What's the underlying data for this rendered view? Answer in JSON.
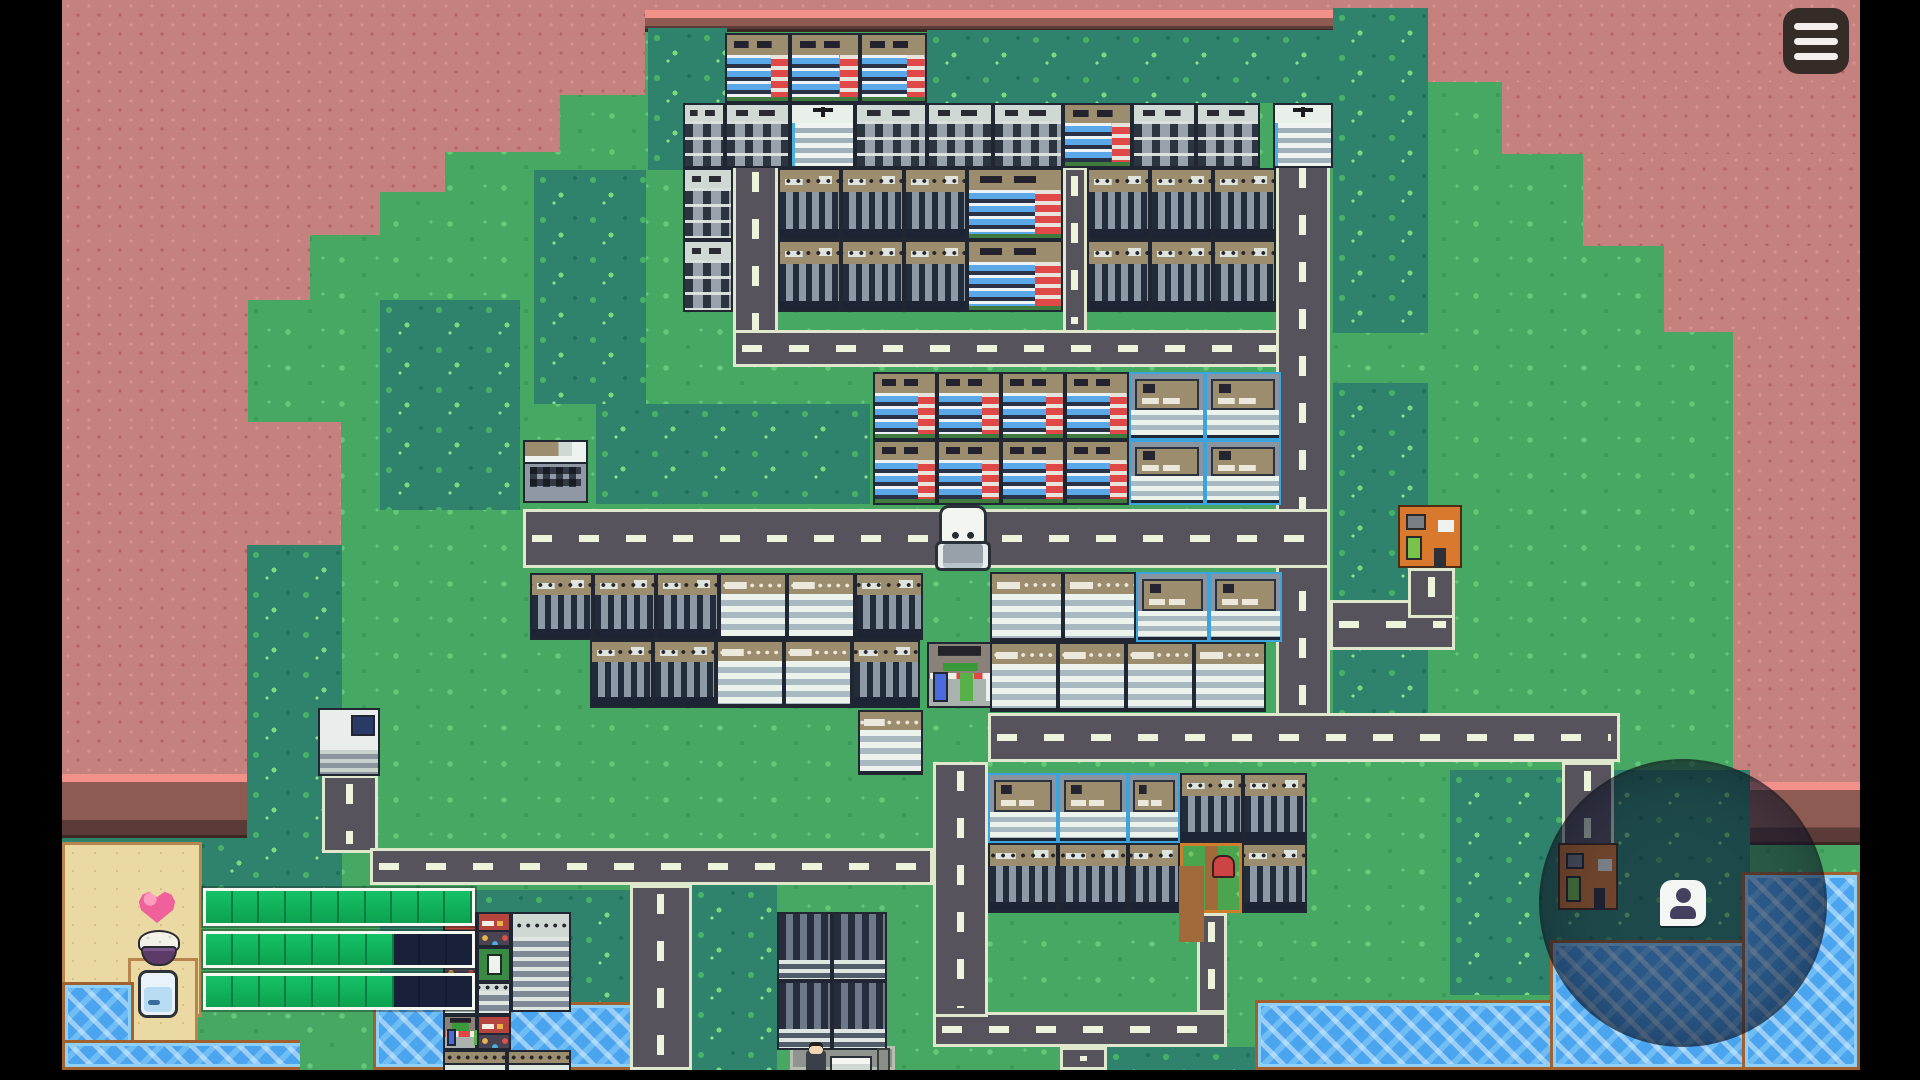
{
  "meta": {
    "app": "pixel-town-survival-game",
    "viewport": {
      "w": 1920,
      "h": 1080
    },
    "content_area": {
      "x": 62,
      "y": 0,
      "w": 1798,
      "h": 1070
    },
    "colors": {
      "grass": "#46a862",
      "tree": "#2f836c",
      "cliff": "#c5817e",
      "water": "#4aa4ee",
      "sand": "#ead9a2",
      "road": "#56535c",
      "road_dash": "#eef4dc",
      "hud_fill": "#10b35c",
      "hud_empty": "#19203a",
      "hud_border": "#f4f8f0",
      "menu_bg": "#352b27",
      "scope_overlay": "rgba(16,22,44,0.52)"
    }
  },
  "menu_button": {
    "icon": "hamburger-menu-icon",
    "bars": 3
  },
  "scope": {
    "x": 1542,
    "y": 762,
    "d": 282,
    "icon": "player-location-pin-icon"
  },
  "hud": {
    "icons_x": 138,
    "bars_x": 203,
    "bars_w": 272,
    "bars": [
      {
        "id": "health",
        "icon": "heart-icon",
        "icon_y": 889,
        "y": 888,
        "h": 38,
        "segments": 10,
        "filled": 10
      },
      {
        "id": "food",
        "icon": "rice-bowl-icon",
        "icon_y": 928,
        "y": 931,
        "h": 37,
        "segments": 10,
        "filled": 7
      },
      {
        "id": "water",
        "icon": "water-glass-icon",
        "icon_y": 970,
        "y": 973,
        "h": 37,
        "segments": 10,
        "filled": 7
      }
    ]
  },
  "map": {
    "terrain": [
      {
        "t": "cliff",
        "n": "cliff-top-strip",
        "x": 62,
        "y": 0,
        "w": 1798,
        "h": 10
      },
      {
        "t": "cliff-foot",
        "n": "cliff-top-strip-foot",
        "x": 62,
        "y": 10,
        "w": 1798,
        "h": 22
      },
      {
        "t": "cliff",
        "n": "cliff-northwest",
        "x": 62,
        "y": 0,
        "w": 583,
        "h": 95
      },
      {
        "t": "cliff",
        "n": "cliff-northwest",
        "x": 62,
        "y": 95,
        "w": 498,
        "h": 57
      },
      {
        "t": "cliff",
        "n": "cliff-northwest",
        "x": 62,
        "y": 152,
        "w": 383,
        "h": 40
      },
      {
        "t": "cliff",
        "n": "cliff-northwest",
        "x": 62,
        "y": 192,
        "w": 318,
        "h": 43
      },
      {
        "t": "cliff",
        "n": "cliff-northwest",
        "x": 62,
        "y": 235,
        "w": 248,
        "h": 65
      },
      {
        "t": "cliff",
        "n": "cliff-west-column",
        "x": 62,
        "y": 300,
        "w": 186,
        "h": 122
      },
      {
        "t": "cliff",
        "n": "cliff-west-bump",
        "x": 62,
        "y": 422,
        "w": 279,
        "h": 152
      },
      {
        "t": "cliff",
        "n": "cliff-west-column",
        "x": 62,
        "y": 574,
        "w": 185,
        "h": 200
      },
      {
        "t": "cliff-foot",
        "n": "cliff-west-bump-foot",
        "x": 247,
        "y": 574,
        "w": 94,
        "h": 62
      },
      {
        "t": "cliff-foot",
        "n": "cliff-west-foot",
        "x": 62,
        "y": 774,
        "w": 185,
        "h": 64
      },
      {
        "t": "cliff",
        "n": "cliff-northeast",
        "x": 1428,
        "y": 0,
        "w": 432,
        "h": 82
      },
      {
        "t": "cliff",
        "n": "cliff-northeast",
        "x": 1502,
        "y": 82,
        "w": 358,
        "h": 72
      },
      {
        "t": "cliff",
        "n": "cliff-northeast",
        "x": 1583,
        "y": 154,
        "w": 277,
        "h": 92
      },
      {
        "t": "cliff",
        "n": "cliff-northeast",
        "x": 1664,
        "y": 246,
        "w": 196,
        "h": 86
      },
      {
        "t": "cliff",
        "n": "cliff-east-column",
        "x": 1733,
        "y": 332,
        "w": 127,
        "h": 450
      },
      {
        "t": "cliff-foot",
        "n": "cliff-east-foot",
        "x": 1733,
        "y": 782,
        "w": 127,
        "h": 63
      },
      {
        "t": "tree",
        "x": 648,
        "y": 28,
        "w": 79,
        "h": 142
      },
      {
        "t": "tree",
        "x": 927,
        "y": 30,
        "w": 406,
        "h": 73
      },
      {
        "t": "tree",
        "x": 1333,
        "y": 8,
        "w": 95,
        "h": 325
      },
      {
        "t": "tree",
        "x": 534,
        "y": 170,
        "w": 112,
        "h": 234
      },
      {
        "t": "tree",
        "x": 380,
        "y": 300,
        "w": 140,
        "h": 210
      },
      {
        "t": "tree",
        "x": 596,
        "y": 404,
        "w": 274,
        "h": 100
      },
      {
        "t": "tree",
        "x": 247,
        "y": 545,
        "w": 95,
        "h": 360
      },
      {
        "t": "tree",
        "x": 62,
        "y": 838,
        "w": 185,
        "h": 62
      },
      {
        "t": "tree",
        "x": 380,
        "y": 890,
        "w": 250,
        "h": 115
      },
      {
        "t": "tree",
        "x": 692,
        "y": 885,
        "w": 85,
        "h": 195
      },
      {
        "t": "tree",
        "x": 1333,
        "y": 383,
        "w": 95,
        "h": 342
      },
      {
        "t": "tree",
        "x": 1450,
        "y": 770,
        "w": 300,
        "h": 225
      },
      {
        "t": "tree",
        "x": 1107,
        "y": 1047,
        "w": 148,
        "h": 23
      },
      {
        "t": "sand",
        "n": "beach",
        "x": 62,
        "y": 842,
        "w": 140,
        "h": 175
      },
      {
        "t": "sand",
        "n": "beach-spit",
        "x": 128,
        "y": 958,
        "w": 70,
        "h": 112
      },
      {
        "t": "water",
        "n": "sea-southwest",
        "x": 62,
        "y": 982,
        "w": 72,
        "h": 88
      },
      {
        "t": "water",
        "n": "sea-southwest",
        "x": 62,
        "y": 1040,
        "w": 246,
        "h": 30
      },
      {
        "t": "grass-patch",
        "x": 300,
        "y": 1022,
        "w": 82,
        "h": 48
      },
      {
        "t": "water",
        "n": "pond",
        "x": 373,
        "y": 1002,
        "w": 285,
        "h": 68
      },
      {
        "t": "water",
        "n": "sea-southeast",
        "x": 1255,
        "y": 1000,
        "w": 605,
        "h": 70
      },
      {
        "t": "water",
        "n": "sea-southeast",
        "x": 1550,
        "y": 940,
        "w": 310,
        "h": 130
      },
      {
        "t": "water",
        "n": "sea-east",
        "x": 1742,
        "y": 872,
        "w": 118,
        "h": 198
      }
    ],
    "roads": [
      {
        "t": "v",
        "n": "road-top-cluster-west",
        "x": 733,
        "y": 163,
        "w": 45,
        "h": 204
      },
      {
        "t": "v",
        "n": "road-top-cluster-alley",
        "x": 1063,
        "y": 167,
        "w": 24,
        "h": 166
      },
      {
        "t": "v",
        "n": "road-factory-stub",
        "x": 322,
        "y": 775,
        "w": 56,
        "h": 78
      },
      {
        "t": "v",
        "n": "road-south-exit-west",
        "x": 630,
        "y": 885,
        "w": 62,
        "h": 185
      },
      {
        "t": "v",
        "n": "road-south-exit-mid",
        "x": 1060,
        "y": 1047,
        "w": 47,
        "h": 23
      },
      {
        "t": "v",
        "n": "road-garden-stub",
        "x": 1197,
        "y": 913,
        "w": 30,
        "h": 100
      },
      {
        "t": "v",
        "n": "road-scope-stub",
        "x": 1562,
        "y": 762,
        "w": 52,
        "h": 85
      },
      {
        "t": "h",
        "n": "road-hardware-spur",
        "x": 1330,
        "y": 600,
        "w": 125,
        "h": 50
      },
      {
        "t": "v",
        "n": "road-hardware-spur",
        "x": 1408,
        "y": 568,
        "w": 47,
        "h": 50
      },
      {
        "t": "h",
        "n": "road-southwest",
        "x": 370,
        "y": 848,
        "w": 563,
        "h": 37
      },
      {
        "t": "h",
        "n": "road-south-connector",
        "x": 933,
        "y": 1012,
        "w": 294,
        "h": 35
      },
      {
        "t": "v",
        "n": "road-mid-south",
        "x": 933,
        "y": 762,
        "w": 55,
        "h": 255
      },
      {
        "t": "h",
        "n": "road-top-cluster-south",
        "x": 733,
        "y": 330,
        "w": 597,
        "h": 37
      },
      {
        "t": "v",
        "n": "road-main-vertical",
        "x": 1276,
        "y": 159,
        "w": 54,
        "h": 566
      },
      {
        "t": "h",
        "n": "road-main-middle",
        "x": 523,
        "y": 509,
        "w": 807,
        "h": 59
      },
      {
        "t": "h",
        "n": "road-main-lower",
        "x": 988,
        "y": 713,
        "w": 632,
        "h": 49
      },
      {
        "t": "plain",
        "n": "sidewalk-market",
        "x": 790,
        "y": 1046,
        "w": 105,
        "h": 24
      }
    ],
    "buildings": [
      {
        "t": "apt",
        "x": 725,
        "y": 33,
        "w": 65,
        "h": 70
      },
      {
        "t": "apt",
        "x": 790,
        "y": 33,
        "w": 70,
        "h": 70
      },
      {
        "t": "apt",
        "x": 860,
        "y": 33,
        "w": 67,
        "h": 70
      },
      {
        "t": "tower",
        "x": 683,
        "y": 103,
        "w": 42,
        "h": 65
      },
      {
        "t": "tower",
        "x": 725,
        "y": 103,
        "w": 65,
        "h": 65
      },
      {
        "t": "whitetower",
        "x": 790,
        "y": 103,
        "w": 65,
        "h": 65
      },
      {
        "t": "tower",
        "x": 855,
        "y": 103,
        "w": 72,
        "h": 65
      },
      {
        "t": "tower",
        "x": 927,
        "y": 103,
        "w": 66,
        "h": 65
      },
      {
        "t": "tower",
        "x": 993,
        "y": 103,
        "w": 70,
        "h": 65
      },
      {
        "t": "apt",
        "x": 1063,
        "y": 103,
        "w": 69,
        "h": 65
      },
      {
        "t": "tower",
        "x": 1132,
        "y": 103,
        "w": 64,
        "h": 65
      },
      {
        "t": "tower",
        "x": 1196,
        "y": 103,
        "w": 64,
        "h": 65
      },
      {
        "t": "whitetower",
        "x": 1273,
        "y": 103,
        "w": 60,
        "h": 65
      },
      {
        "t": "tower",
        "x": 683,
        "y": 168,
        "w": 50,
        "h": 72
      },
      {
        "t": "ware",
        "x": 778,
        "y": 168,
        "w": 63,
        "h": 72
      },
      {
        "t": "ware",
        "x": 841,
        "y": 168,
        "w": 63,
        "h": 72
      },
      {
        "t": "ware",
        "x": 904,
        "y": 168,
        "w": 63,
        "h": 72
      },
      {
        "t": "apt",
        "x": 967,
        "y": 168,
        "w": 96,
        "h": 72
      },
      {
        "t": "ware",
        "x": 1087,
        "y": 168,
        "w": 63,
        "h": 72
      },
      {
        "t": "ware",
        "x": 1150,
        "y": 168,
        "w": 63,
        "h": 72
      },
      {
        "t": "ware",
        "x": 1213,
        "y": 168,
        "w": 63,
        "h": 72
      },
      {
        "t": "tower",
        "x": 683,
        "y": 240,
        "w": 50,
        "h": 72
      },
      {
        "t": "ware",
        "x": 778,
        "y": 240,
        "w": 63,
        "h": 72
      },
      {
        "t": "ware",
        "x": 841,
        "y": 240,
        "w": 63,
        "h": 72
      },
      {
        "t": "ware",
        "x": 904,
        "y": 240,
        "w": 63,
        "h": 72
      },
      {
        "t": "apt",
        "x": 967,
        "y": 240,
        "w": 96,
        "h": 72
      },
      {
        "t": "ware",
        "x": 1087,
        "y": 240,
        "w": 63,
        "h": 72
      },
      {
        "t": "ware",
        "x": 1150,
        "y": 240,
        "w": 63,
        "h": 72
      },
      {
        "t": "ware",
        "x": 1213,
        "y": 240,
        "w": 63,
        "h": 72
      },
      {
        "t": "apt",
        "x": 873,
        "y": 372,
        "w": 64,
        "h": 68
      },
      {
        "t": "apt",
        "x": 937,
        "y": 372,
        "w": 64,
        "h": 68
      },
      {
        "t": "apt",
        "x": 1001,
        "y": 372,
        "w": 64,
        "h": 68
      },
      {
        "t": "apt",
        "x": 1065,
        "y": 372,
        "w": 64,
        "h": 68
      },
      {
        "t": "office2",
        "x": 1129,
        "y": 372,
        "w": 76,
        "h": 68
      },
      {
        "t": "office2",
        "x": 1205,
        "y": 372,
        "w": 76,
        "h": 68
      },
      {
        "t": "apt",
        "x": 873,
        "y": 440,
        "w": 64,
        "h": 65
      },
      {
        "t": "apt",
        "x": 937,
        "y": 440,
        "w": 64,
        "h": 65
      },
      {
        "t": "apt",
        "x": 1001,
        "y": 440,
        "w": 64,
        "h": 65
      },
      {
        "t": "apt",
        "x": 1065,
        "y": 440,
        "w": 64,
        "h": 65
      },
      {
        "t": "office2",
        "x": 1129,
        "y": 440,
        "w": 76,
        "h": 65
      },
      {
        "t": "office2",
        "x": 1205,
        "y": 440,
        "w": 76,
        "h": 65
      },
      {
        "t": "smalloffice",
        "n": "office-road-end",
        "x": 523,
        "y": 440,
        "w": 65,
        "h": 63
      },
      {
        "t": "hardware",
        "n": "hardware-store",
        "x": 1398,
        "y": 505,
        "w": 64,
        "h": 63
      },
      {
        "t": "ware",
        "x": 530,
        "y": 573,
        "w": 63,
        "h": 67
      },
      {
        "t": "ware",
        "x": 593,
        "y": 573,
        "w": 63,
        "h": 67
      },
      {
        "t": "ware",
        "x": 656,
        "y": 573,
        "w": 63,
        "h": 67
      },
      {
        "t": "office",
        "x": 719,
        "y": 573,
        "w": 68,
        "h": 67
      },
      {
        "t": "office",
        "x": 787,
        "y": 573,
        "w": 68,
        "h": 67
      },
      {
        "t": "ware",
        "x": 855,
        "y": 573,
        "w": 68,
        "h": 67
      },
      {
        "t": "ware",
        "x": 590,
        "y": 640,
        "w": 63,
        "h": 68
      },
      {
        "t": "ware",
        "x": 653,
        "y": 640,
        "w": 63,
        "h": 68
      },
      {
        "t": "office",
        "x": 716,
        "y": 640,
        "w": 68,
        "h": 68
      },
      {
        "t": "office",
        "x": 784,
        "y": 640,
        "w": 68,
        "h": 68
      },
      {
        "t": "ware",
        "x": 852,
        "y": 640,
        "w": 68,
        "h": 68
      },
      {
        "t": "office",
        "x": 858,
        "y": 710,
        "w": 65,
        "h": 65
      },
      {
        "t": "shopawning",
        "n": "corner-store",
        "x": 927,
        "y": 642,
        "w": 66,
        "h": 66
      },
      {
        "t": "office",
        "x": 990,
        "y": 572,
        "w": 73,
        "h": 70
      },
      {
        "t": "office",
        "x": 1063,
        "y": 572,
        "w": 73,
        "h": 70
      },
      {
        "t": "office2",
        "x": 1136,
        "y": 572,
        "w": 73,
        "h": 70
      },
      {
        "t": "office2",
        "x": 1209,
        "y": 572,
        "w": 73,
        "h": 70
      },
      {
        "t": "office",
        "x": 990,
        "y": 642,
        "w": 68,
        "h": 70
      },
      {
        "t": "office",
        "x": 1058,
        "y": 642,
        "w": 68,
        "h": 70
      },
      {
        "t": "office",
        "x": 1126,
        "y": 642,
        "w": 68,
        "h": 70
      },
      {
        "t": "office",
        "x": 1194,
        "y": 642,
        "w": 72,
        "h": 70
      },
      {
        "t": "machine",
        "n": "factory-unit",
        "x": 318,
        "y": 708,
        "w": 62,
        "h": 68
      },
      {
        "t": "office2",
        "x": 988,
        "y": 773,
        "w": 70,
        "h": 70
      },
      {
        "t": "office2",
        "x": 1058,
        "y": 773,
        "w": 70,
        "h": 70
      },
      {
        "t": "office2",
        "x": 1128,
        "y": 773,
        "w": 52,
        "h": 70
      },
      {
        "t": "ware",
        "x": 1180,
        "y": 773,
        "w": 63,
        "h": 70
      },
      {
        "t": "ware",
        "x": 1243,
        "y": 773,
        "w": 64,
        "h": 70
      },
      {
        "t": "ware",
        "x": 988,
        "y": 843,
        "w": 70,
        "h": 70
      },
      {
        "t": "ware",
        "x": 1058,
        "y": 843,
        "w": 70,
        "h": 70
      },
      {
        "t": "ware",
        "x": 1128,
        "y": 843,
        "w": 52,
        "h": 70
      },
      {
        "t": "garden",
        "n": "community-garden",
        "x": 1180,
        "y": 843,
        "w": 62,
        "h": 70
      },
      {
        "t": "ware",
        "x": 1242,
        "y": 843,
        "w": 65,
        "h": 70
      },
      {
        "t": "dark",
        "x": 777,
        "y": 912,
        "w": 55,
        "h": 69
      },
      {
        "t": "dark",
        "x": 832,
        "y": 912,
        "w": 55,
        "h": 69
      },
      {
        "t": "dark",
        "x": 777,
        "y": 981,
        "w": 55,
        "h": 69
      },
      {
        "t": "dark",
        "x": 832,
        "y": 981,
        "w": 55,
        "h": 69
      },
      {
        "t": "redshop",
        "x": 443,
        "y": 912,
        "w": 34,
        "h": 35
      },
      {
        "t": "redshop",
        "x": 477,
        "y": 912,
        "w": 34,
        "h": 35
      },
      {
        "t": "redshop",
        "x": 443,
        "y": 947,
        "w": 34,
        "h": 35
      },
      {
        "t": "greenvend",
        "x": 477,
        "y": 947,
        "w": 34,
        "h": 35
      },
      {
        "t": "grayshop",
        "x": 443,
        "y": 982,
        "w": 34,
        "h": 33
      },
      {
        "t": "grayshop",
        "x": 477,
        "y": 982,
        "w": 34,
        "h": 33
      },
      {
        "t": "grayshop",
        "x": 511,
        "y": 912,
        "w": 60,
        "h": 100
      },
      {
        "t": "shopawning",
        "x": 443,
        "y": 1015,
        "w": 34,
        "h": 35
      },
      {
        "t": "redshop",
        "x": 477,
        "y": 1015,
        "w": 34,
        "h": 35
      },
      {
        "t": "tan",
        "x": 443,
        "y": 1050,
        "w": 64,
        "h": 28
      },
      {
        "t": "tan",
        "x": 507,
        "y": 1050,
        "w": 64,
        "h": 28
      },
      {
        "t": "hardware",
        "n": "store-under-scope",
        "x": 1558,
        "y": 843,
        "w": 60,
        "h": 67
      }
    ],
    "props": [
      {
        "t": "player",
        "n": "player-character",
        "x": 935,
        "y": 505,
        "w": 52,
        "h": 68
      },
      {
        "t": "npc",
        "n": "villager",
        "x": 806,
        "y": 1050,
        "w": 20,
        "h": 28
      },
      {
        "t": "stall",
        "n": "market-stall",
        "x": 830,
        "y": 1056,
        "w": 42,
        "h": 24
      },
      {
        "t": "pillar",
        "n": "street-post",
        "x": 877,
        "y": 1048,
        "w": 13,
        "h": 30
      }
    ]
  }
}
